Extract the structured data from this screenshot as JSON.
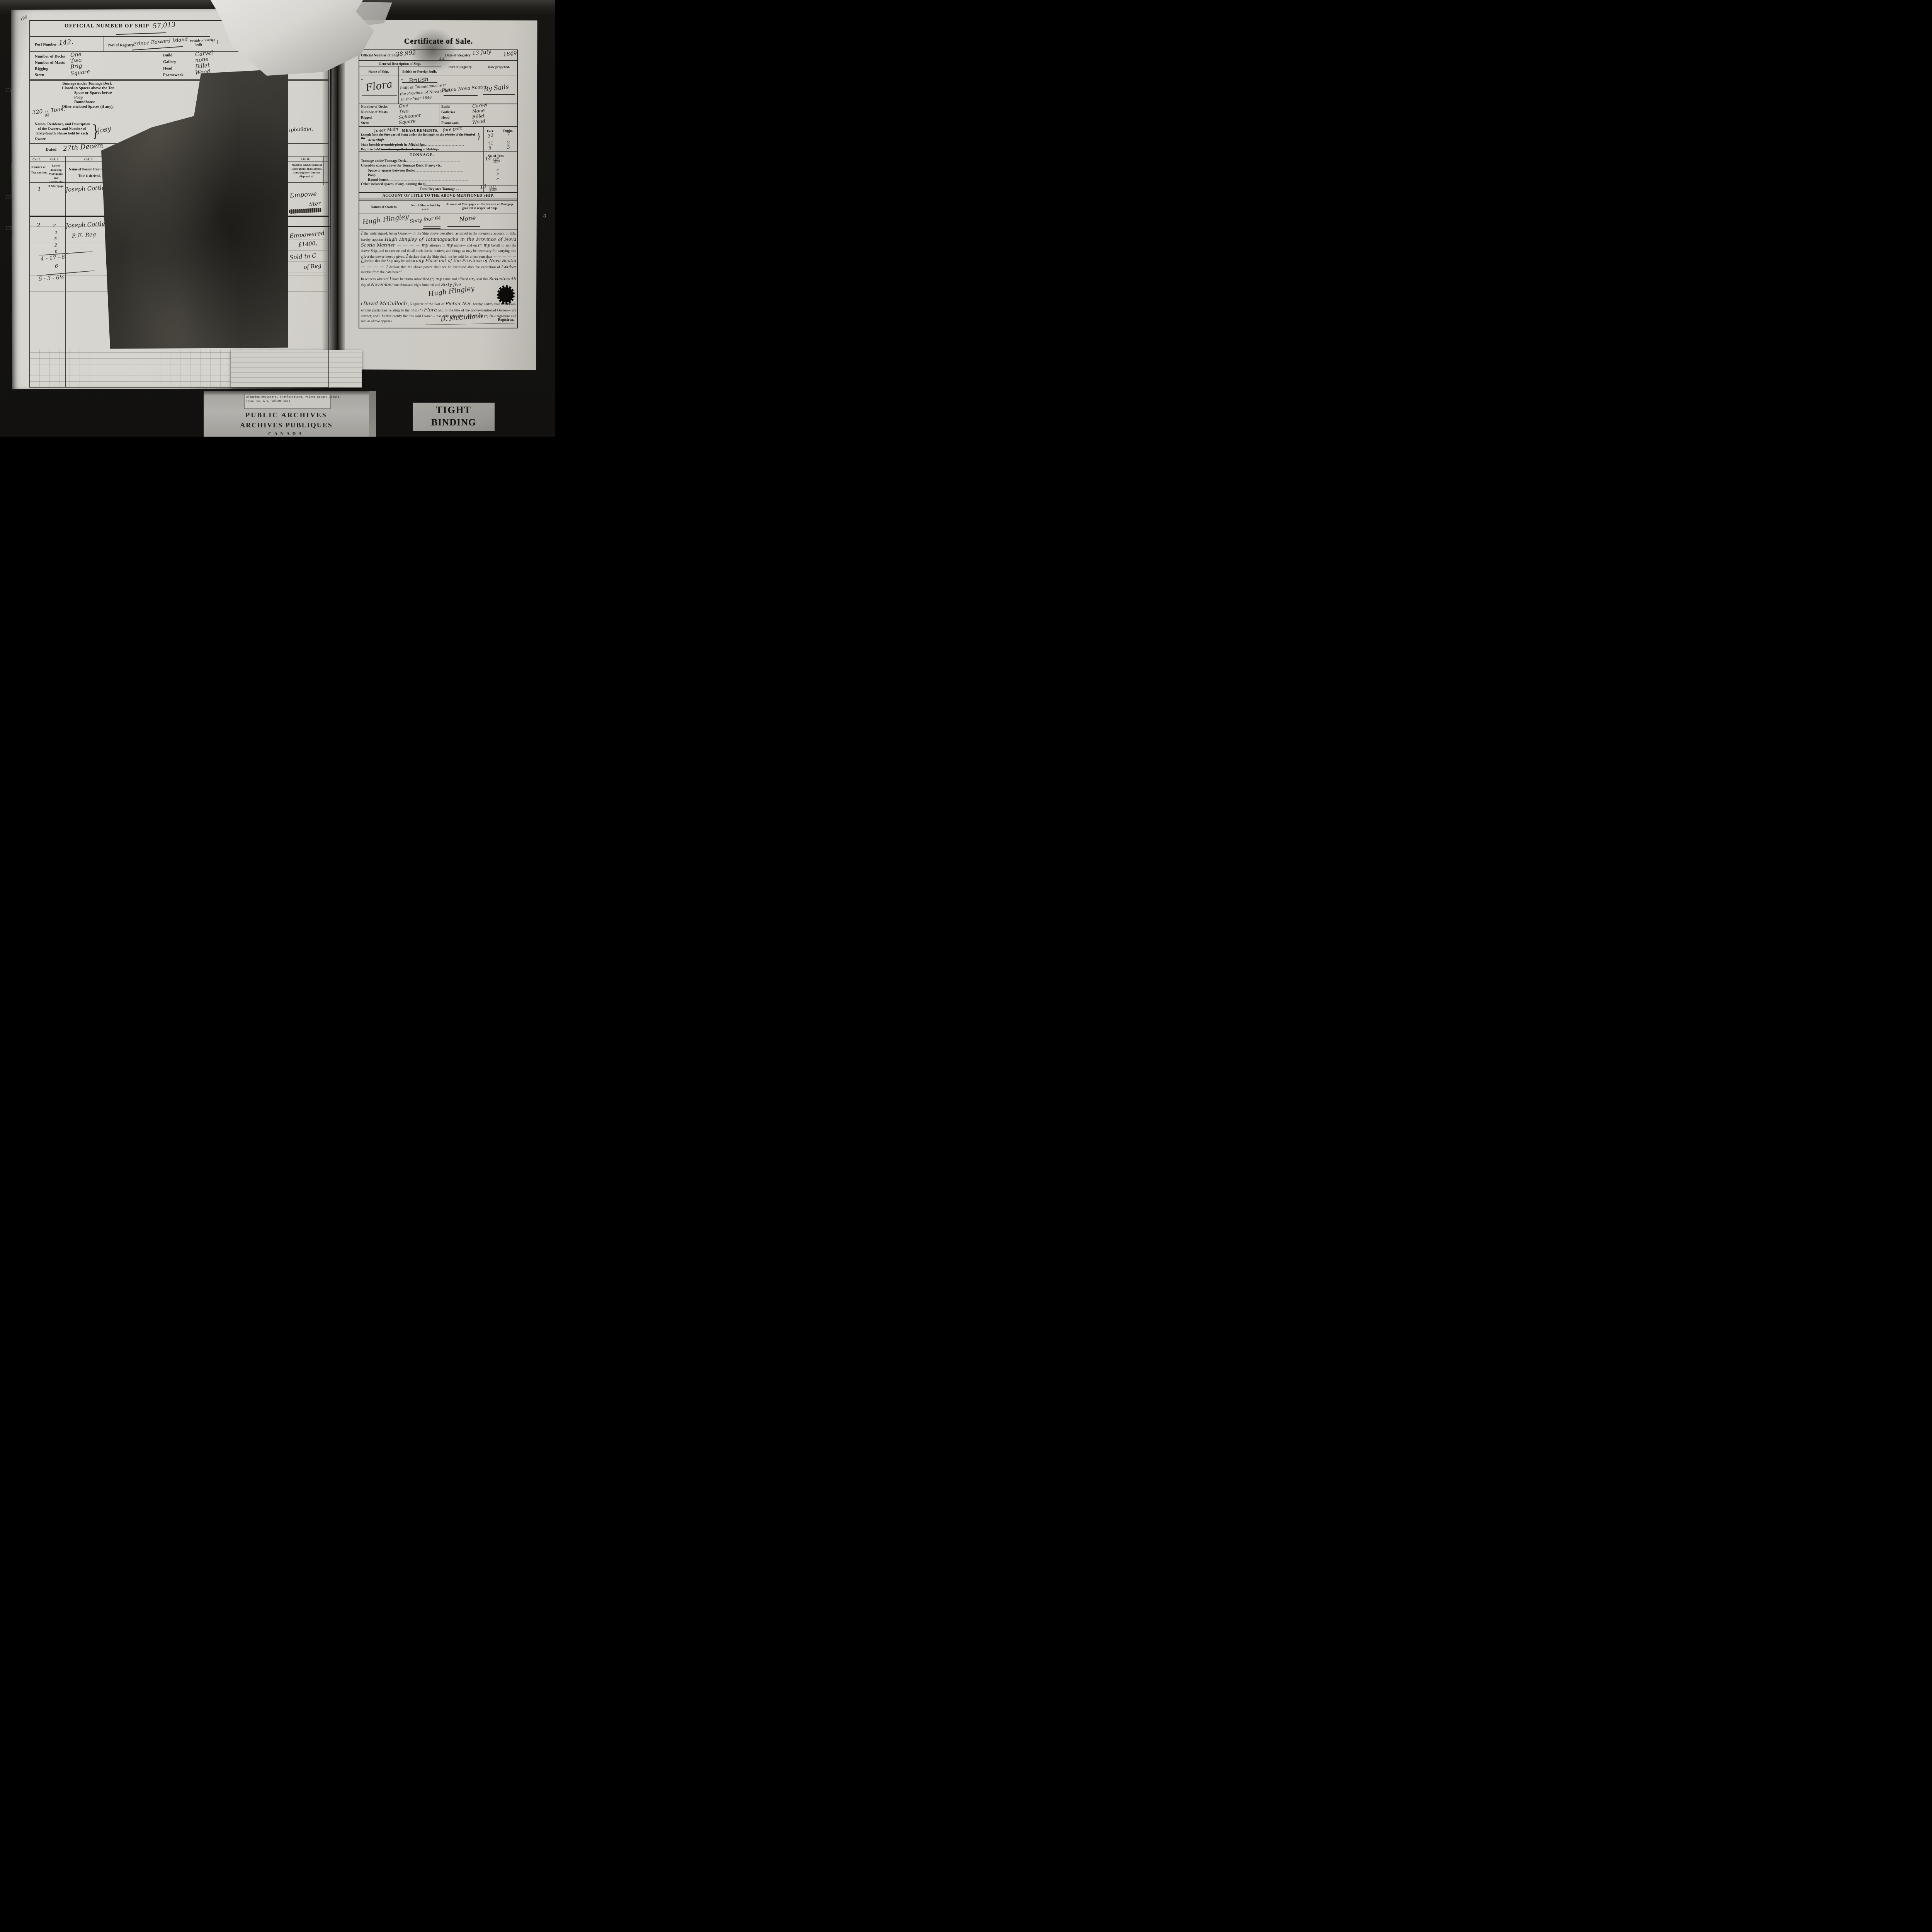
{
  "photo": {
    "page_corner_number": "196",
    "margin_marks": [
      "Cp",
      "Cp",
      "Cp"
    ],
    "right_margin_mark": "0"
  },
  "left_page": {
    "official_number": {
      "label": "OFFICIAL NUMBER OF SHIP",
      "value": "57,013"
    },
    "port_row": {
      "port_number_label": "Port Number . . .",
      "port_number_value": "142.",
      "registry_label": "Port of Registry . .",
      "registry_value": "Prince Edward Island",
      "built_label_line1": "British or Foreign",
      "built_label_line2": "built",
      "built_brace": "} . . . ."
    },
    "specs_left": [
      {
        "label": "Number of Decks",
        "value": "One"
      },
      {
        "label": "Number of Masts",
        "value": "Two"
      },
      {
        "label": "Rigging",
        "value": "Brig"
      },
      {
        "label": "Stern",
        "value": "Square"
      }
    ],
    "specs_right": [
      {
        "label": "Build",
        "value": "Carvel"
      },
      {
        "label": "Gallery",
        "value": "none"
      },
      {
        "label": "Head",
        "value": "Billet"
      },
      {
        "label": "Framework",
        "value": "Wood"
      }
    ],
    "tonnage_lines": [
      "Tonnage under Tonnage Deck",
      "Closed-in Spaces above the Ton",
      "Space or Spaces betwe",
      "Poop",
      "Roundhouse",
      "Other enclosed Spaces (if any),"
    ],
    "tons": {
      "whole": "320",
      "num": "15",
      "den": "94",
      "unit": "Tons."
    },
    "owners_heading": [
      "Names, Residence, and Description",
      "of the Owners, and Number of",
      "Sixty-fourth Shares held by each",
      "Owner      -        -        -"
    ],
    "owners_brace": "}",
    "owners_value": "Josy",
    "shipbuilder_note": "ipbuilder,",
    "dated": {
      "label": "Dated",
      "value": "27th Decem"
    },
    "col_labels": {
      "col1": "Col. 1.",
      "col2": "Col. 2.",
      "col3": "Col. 3."
    },
    "col_headers": {
      "col1": "Number of Transaction.",
      "col2": "Letter denoting Mortgages, and Certificates of Mortgage.",
      "col3": "Name of Person from whom Title is derived."
    },
    "transactions": [
      {
        "number": "1",
        "name": "Joseph Cottle Morris"
      },
      {
        "number": "2",
        "col2_value": "2",
        "name": "Joseph Cottle Morris",
        "name2": "P. E. Reg"
      }
    ],
    "ledger": {
      "stack": [
        "2",
        "5",
        "2",
        "6"
      ],
      "sum1": "4 - 17 - 6",
      "sum2": "6",
      "sum3": "5 - 3 - 6½"
    }
  },
  "middle_strip": {
    "col8_label": "Col. 8.",
    "col8_header": "Number and Account of subsequent Transaction, showing how Interest disposed of.",
    "upper_note1": "Empowe",
    "upper_note2": "Ster",
    "lower_note1": "Empowered",
    "lower_note2": "£1400,",
    "lower_note3": "Sold to C",
    "lower_note4": "of Reg"
  },
  "right_page": {
    "title": "Certificate of Sale.",
    "official_row": {
      "number_label": "Official Number of Ship",
      "number_value": "38,992",
      "small_value": "44",
      "date_label": "Date of Registry",
      "date_value": "13 July",
      "year_value": "1849"
    },
    "description": {
      "heading": "General Description of Ship.",
      "name_label": "Name of Ship.",
      "built_label": "British or Foreign built.",
      "registry_label": "Port of Registry.",
      "propelled_label": "How propelled.",
      "star1": "*",
      "star2": "*",
      "name_value": "Flora",
      "built_value_line0": "British",
      "built_value_lines": [
        "Built at Tatamagouche in",
        "the Province of Nova Scotia",
        "in the Year 1849"
      ],
      "registry_value": "Pictou Nova Scotia",
      "propelled_value": "By Sails"
    },
    "specs_left": [
      {
        "label": "Number of Decks",
        "value": "One"
      },
      {
        "label": "Number of Masts",
        "value": "Two"
      },
      {
        "label": "Rigged",
        "value": "Schooner"
      },
      {
        "label": "Stern",
        "value": "Square"
      }
    ],
    "specs_right": [
      {
        "label": "Build",
        "value": "Carvel"
      },
      {
        "label": "Galleries",
        "value": "None"
      },
      {
        "label": "Head",
        "value": "Billet"
      },
      {
        "label": "Framework",
        "value": "Wood"
      }
    ],
    "measurements": {
      "script_before": "Inner Main",
      "heading": "MEASUREMENTS.",
      "script_after": "fore part",
      "feet_label": "Feet.",
      "tenths_label": "Tenths.",
      "row1": {
        "seg1": "Length from the ",
        "strike1": "fore",
        "seg2": " part of Stem under the Bowsprit to the ",
        "strike2": "aft side",
        "seg3": " of the ",
        "strike3": "Head of the",
        "line2_seg1": "stern ",
        "line2_strike": "aloft",
        "brace": "}",
        "feet": "32",
        "tenths": "7"
      },
      "row2": {
        "seg1": "Main breadth ",
        "strike1": "to outside plank",
        "script1": "in Midships",
        "feet": "11",
        "tenths": "2"
      },
      "row3": {
        "seg1": "Depth in hold ",
        "strike1": "from Tonnage Deck to Ceiling",
        "seg2": " at Midships",
        "feet": "5",
        "tenths": "3"
      }
    },
    "tonnage": {
      "heading": "TONNAGE.",
      "tons_col_label": "No. of Tons.",
      "row1_label": "Tonnage under Tonnage Deck",
      "row1_value": {
        "whole": "14",
        "num": "1632",
        "den": "3500"
      },
      "row2_label": "Closed-in spaces above the Tonnage Deck, if any; viz.:",
      "row3_label": "Space or spaces between Decks",
      "row3_value": "〃",
      "row4_label": "Poop",
      "row4_value": "〃",
      "row5_label": "Round-house",
      "row5_value": "〃",
      "row6_label": "Other inclosed spaces, if any, naming them",
      "total_label": "Total Register Tonnage . . . .",
      "total_value": {
        "whole": "14",
        "num": "1632",
        "den": "3500"
      }
    },
    "account_title": {
      "heading": "ACCOUNT OF TITLE TO THE ABOVE-MENTIONED SHIP.",
      "owners_label": "Names of Owners.",
      "shares_label": "No. of Shares held by each.",
      "mortgages_label_line1": "Account of Mortgages or Certificates of Mortgage",
      "mortgages_label_line2": "granted in respect of Ship.",
      "owner_value": "Hugh Hingley",
      "shares_value": "Sixty four 64",
      "mortgages_value": "None"
    },
    "appoint_para": [
      {
        "t": "I"
      },
      {
        "t": " the undersigned, being Owner— of the Ship above described, as stated in the foregoing account of title, hereby appoint "
      },
      {
        "t": "Hugh Hingley of Tatamagouche in the Province of Nova Scotia Mariner — — — — "
      },
      {
        "t": "my"
      },
      {
        "t": " attorney in "
      },
      {
        "t": "my"
      },
      {
        "t": " name— and on (*) "
      },
      {
        "t": "my"
      },
      {
        "t": " behalf to sell the above Ship, and to execute and do all such deeds, matters, and things as may be necessary for carrying into effect the power hereby given. "
      },
      {
        "t": "I"
      },
      {
        "t": " declare that the Ship shall not be sold for a less sum than "
      },
      {
        "t": "— — — — — —"
      }
    ],
    "sale_para": [
      {
        "t": "I"
      },
      {
        "t": " declare that the Ship may be sold at "
      },
      {
        "t": "any Place out of the Province of Nova Scotia — — — — "
      },
      {
        "t": "I"
      },
      {
        "t": " declare that the above power shall not be exercised after the expiration of "
      },
      {
        "t": "twelve"
      },
      {
        "t": " months from the date hereof."
      }
    ],
    "witness_para": [
      {
        "t": "In witness whereof "
      },
      {
        "t": "I"
      },
      {
        "t": " have hereunto subscribed (*) "
      },
      {
        "t": "my"
      },
      {
        "t": " name and affixed "
      },
      {
        "t": "my"
      },
      {
        "t": " seal this "
      },
      {
        "t": "Seventeenth"
      },
      {
        "t": " day of "
      },
      {
        "t": "November"
      },
      {
        "t": " one thousand eight hundred and "
      },
      {
        "t": "Sixty five"
      }
    ],
    "owner_signature": "Hugh Hingley",
    "certify_para": [
      {
        "t": "I "
      },
      {
        "t": "David McCulloch"
      },
      {
        "t": " , Registrar of the Port of "
      },
      {
        "t": "Pictou N.S."
      },
      {
        "t": " hereby certify that the above-written particulars relating to the Ship (*) "
      },
      {
        "t": "Flora"
      },
      {
        "t": " and to the title of the above-mentioned Owner— are correct; and I further certify that the said Owner— has duly subscribed and affixed (*) "
      },
      {
        "t": "his"
      },
      {
        "t": " signature and seal as above appears."
      }
    ],
    "registrar_signature": "D. McCulloch",
    "registrar_title": "Registrar."
  },
  "footer": {
    "typed_line1": "Shipping Registers.  Charlottetown, Prince Edward Island.",
    "typed_line2": "(R.G. 12, A 1, Volume 164)",
    "archives_line1": "PUBLIC ARCHIVES",
    "archives_line2": "ARCHIVES PUBLIQUES",
    "archives_line3": "CANADA",
    "binding_line1": "TIGHT",
    "binding_line2": "BINDING"
  }
}
